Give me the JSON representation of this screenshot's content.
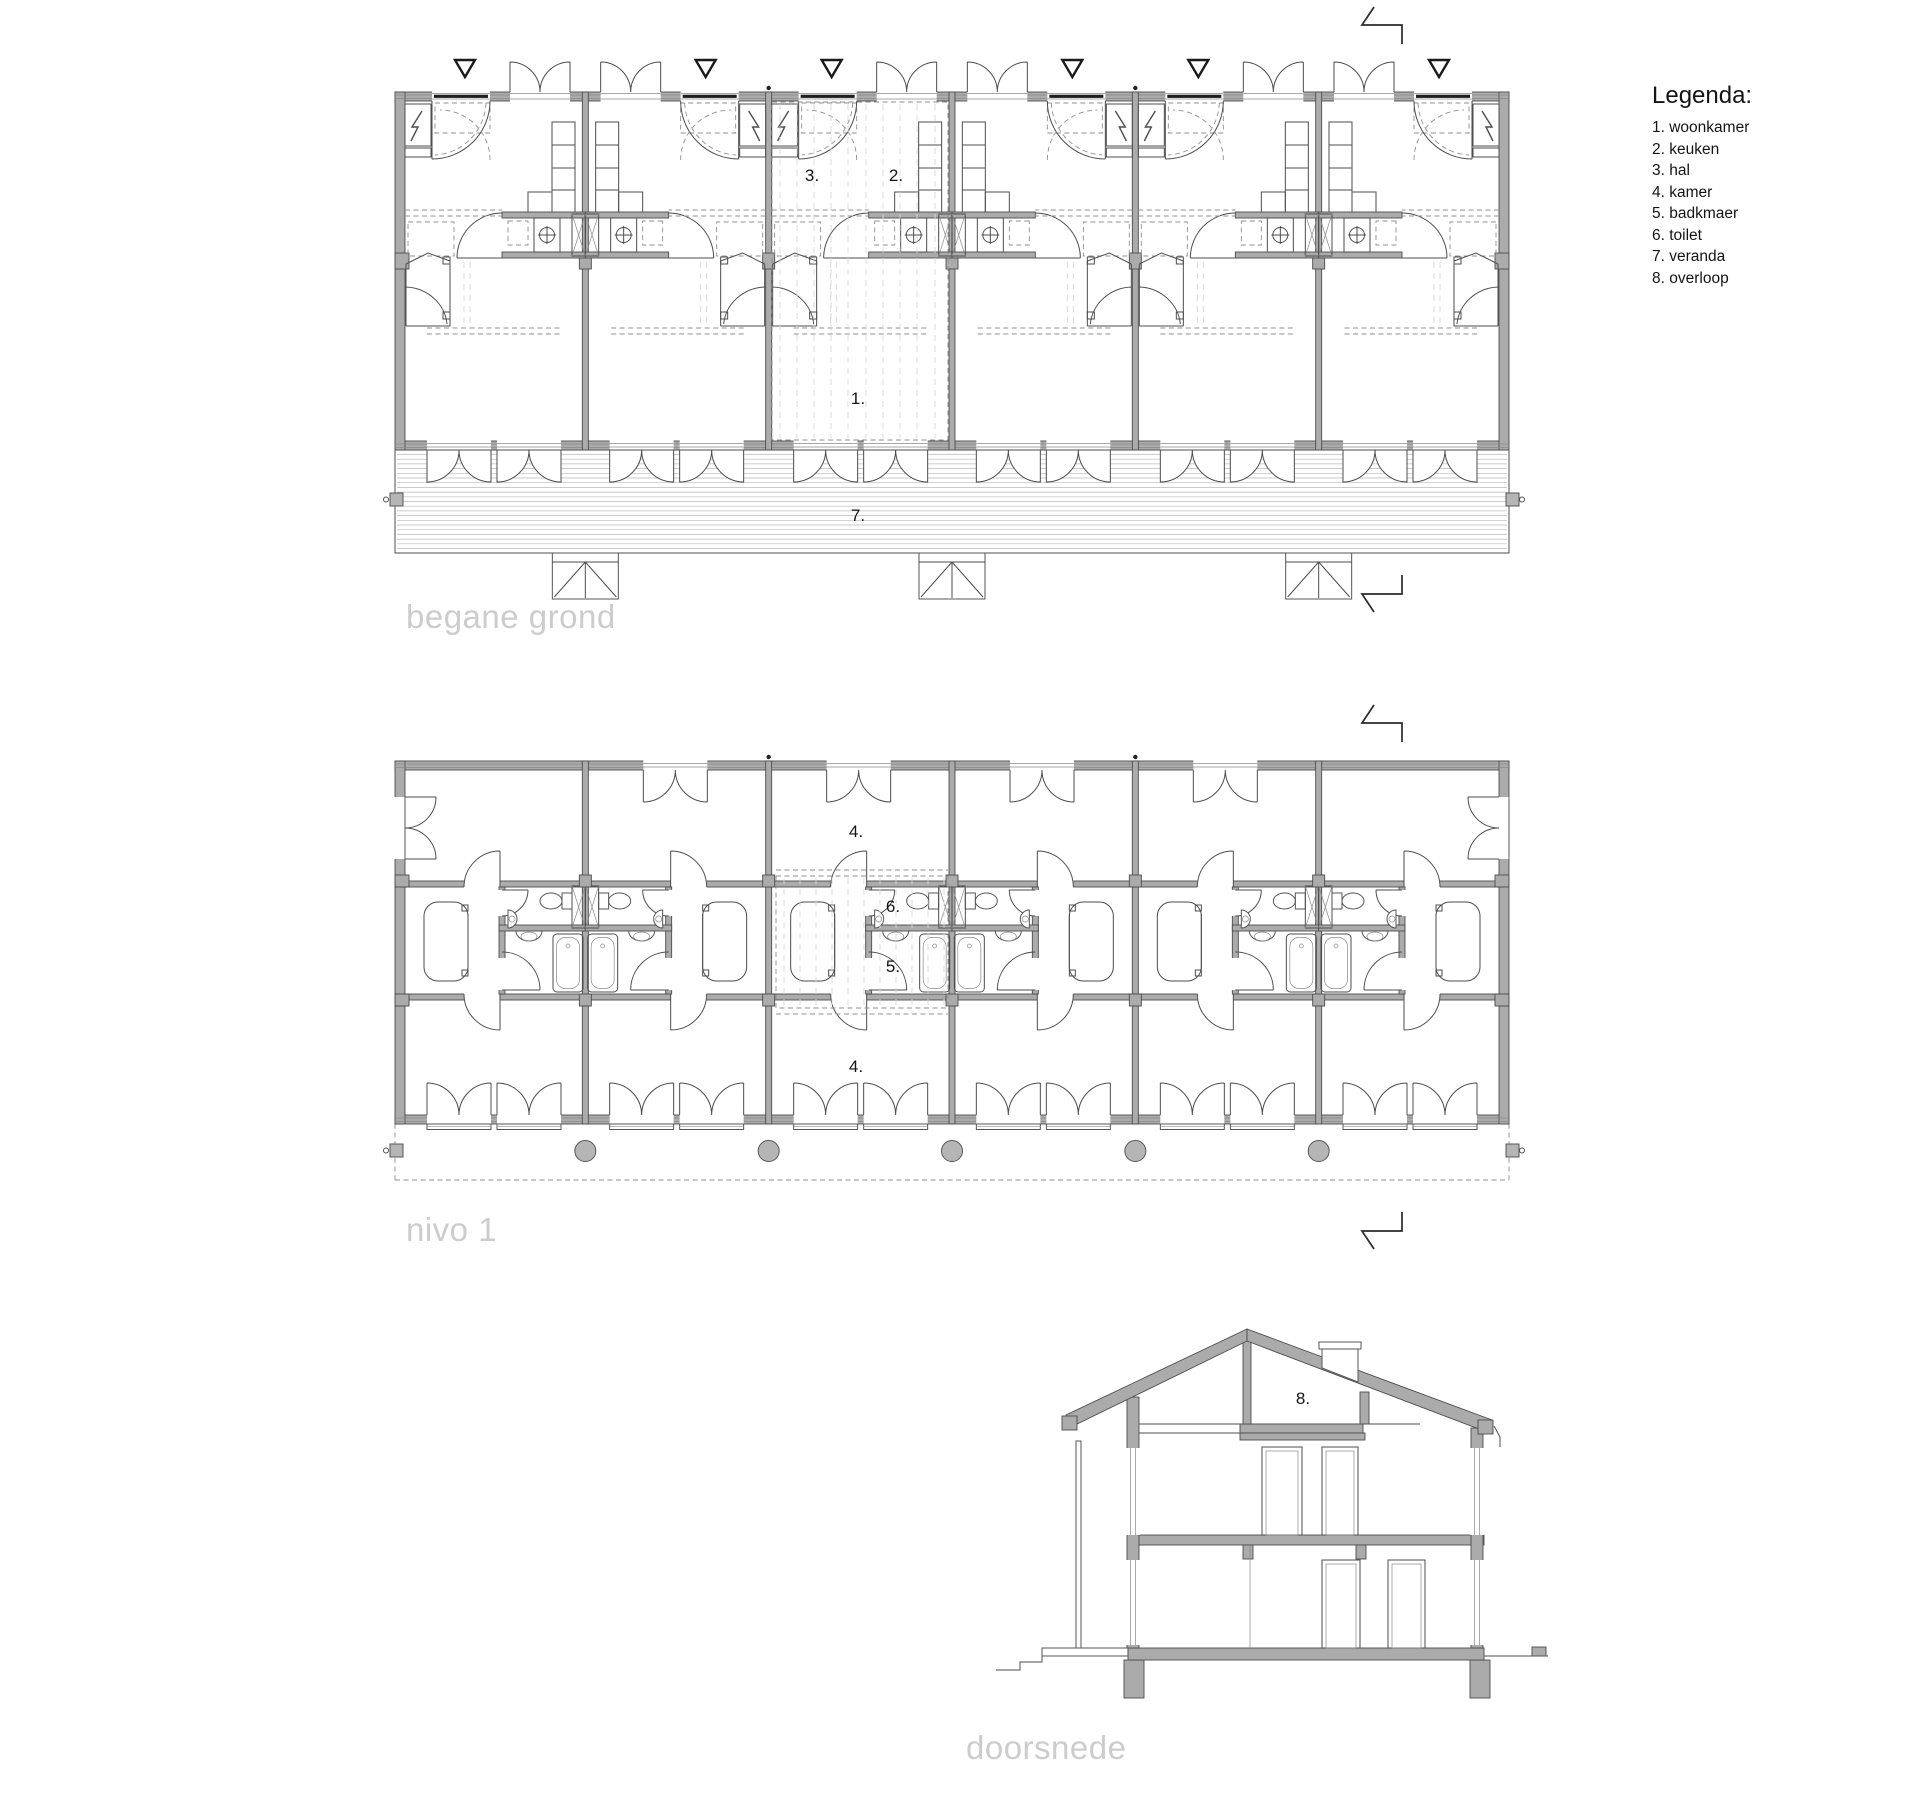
{
  "legend": {
    "title": "Legenda:",
    "items": [
      "1. woonkamer",
      "2. keuken",
      "3. hal",
      "4. kamer",
      "5. badkmaer",
      "6. toilet",
      "7. veranda",
      "8. overloop"
    ]
  },
  "plans": {
    "ground": {
      "title": "begane grond",
      "room_labels": {
        "hal": "3.",
        "keuken": "2.",
        "woonkamer": "1.",
        "veranda": "7."
      }
    },
    "level1": {
      "title": "nivo 1",
      "room_labels": {
        "kamer_top": "4.",
        "toilet": "6.",
        "badkamer": "5.",
        "kamer_bottom": "4."
      }
    },
    "section": {
      "title": "doorsnede",
      "room_labels": {
        "overloop": "8."
      }
    }
  },
  "icons": {
    "entrance_marker": "triangle-down",
    "section_cut": "section-cut-zigzag",
    "electric_meter": "lightning-zigzag"
  },
  "colors": {
    "wall_fill": "#ababab",
    "line": "#4d4d4d",
    "dark_glazing": "#1f1f1f",
    "column_fill": "#b5b5b5",
    "dashed": "#8f8f8f",
    "hatch": "#d8d8d8",
    "title_text": "#cccccc",
    "label_text": "#141414",
    "background": "#ffffff"
  }
}
